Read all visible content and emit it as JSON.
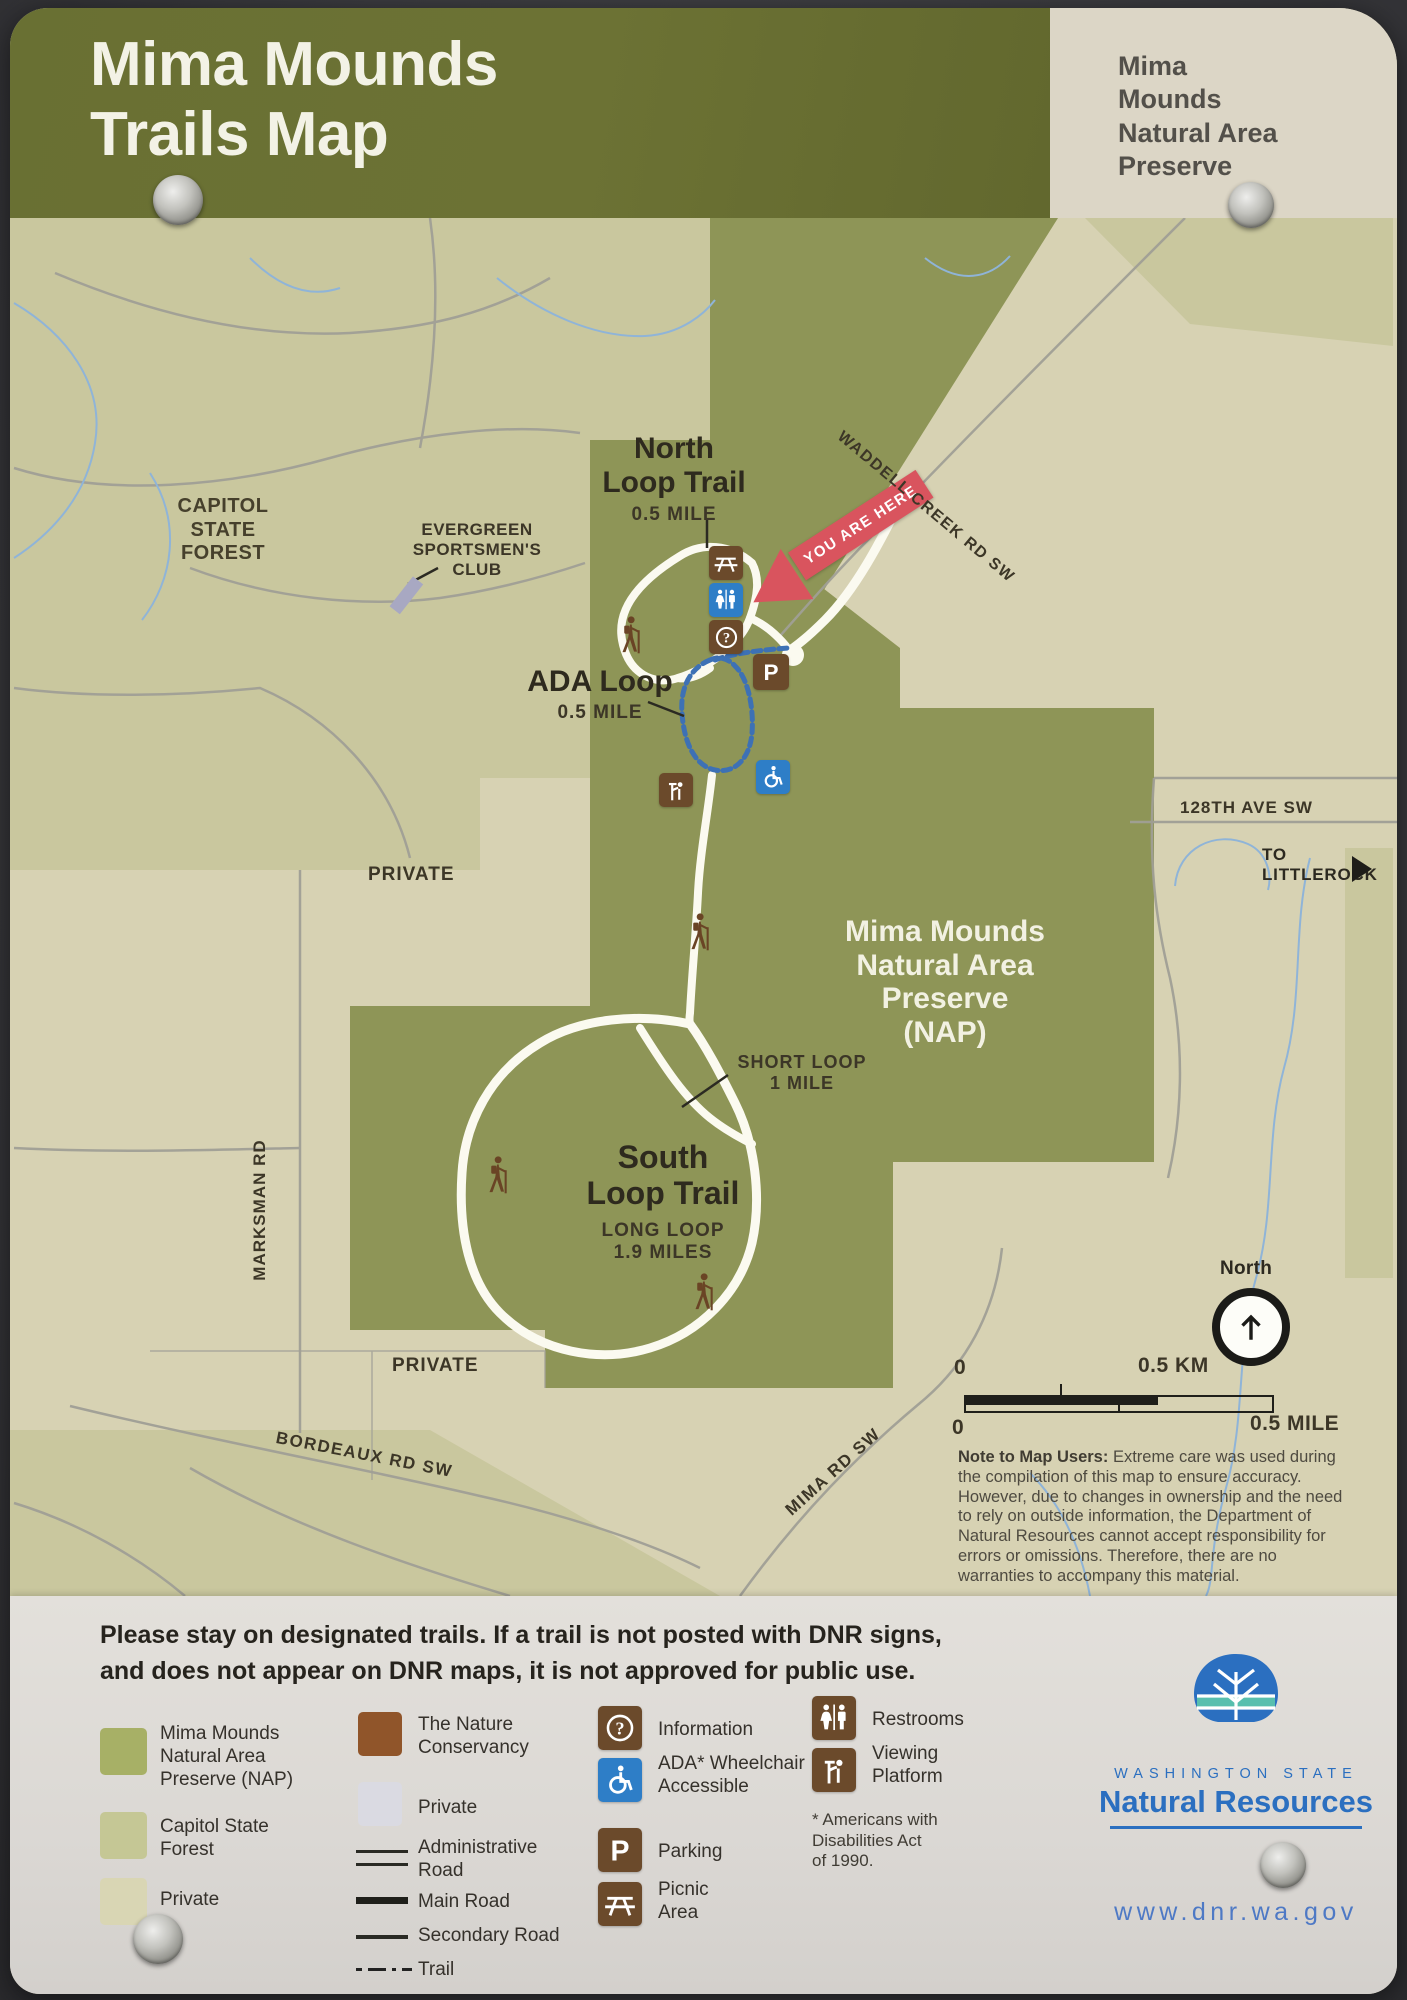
{
  "header": {
    "title": "Mima Mounds\nTrails Map",
    "corner_label": "Mima\nMounds\nNatural Area\nPreserve"
  },
  "map": {
    "labels": {
      "capitol_forest": "CAPITOL\nSTATE\nFOREST",
      "evergreen_club": "EVERGREEN\nSPORTSMEN'S\nCLUB",
      "north_loop_title": "North\nLoop Trail",
      "north_loop_distance": "0.5 MILE",
      "ada_loop_title": "ADA Loop",
      "ada_loop_distance": "0.5 MILE",
      "you_are_here": "YOU ARE HERE",
      "waddell_creek_rd": "WADDELL CREEK RD SW",
      "ave_128th": "128TH AVE SW",
      "to_littlerock": "TO LITTLEROCK",
      "private_upper": "PRIVATE",
      "private_lower": "PRIVATE",
      "nap_area": "Mima Mounds\nNatural Area\nPreserve\n(NAP)",
      "short_loop": "SHORT LOOP\n1 MILE",
      "south_loop_title": "South\nLoop Trail",
      "south_loop_sub": "LONG LOOP\n1.9 MILES",
      "marksman_rd": "MARKSMAN RD",
      "bordeaux_rd": "BORDEAUX RD SW",
      "mima_rd": "MIMA RD SW",
      "north_compass": "North"
    },
    "scale": {
      "zero_km": "0",
      "km": "0.5 KM",
      "zero_mile": "0",
      "mile": "0.5 MILE"
    },
    "note_title": "Note to Map Users:",
    "note_body": " Extreme care was used during the compilation of this map to ensure accuracy. However, due to changes in ownership and the need to rely on outside information, the Department of Natural Resources cannot accept responsibility for errors or omissions. Therefore, there are no warranties to accompany this material."
  },
  "legend": {
    "notice": "Please stay on designated trails. If a trail is not posted with DNR signs,\nand does not appear on DNR maps, it is not approved for public use.",
    "areas": {
      "nap": "Mima Mounds\nNatural Area\nPreserve (NAP)",
      "capitol": "Capitol State\nForest",
      "private": "Private"
    },
    "symbols": {
      "conservancy": "The Nature\nConservancy",
      "private": "Private",
      "admin_road": "Administrative\nRoad",
      "main_road": "Main Road",
      "secondary_road": "Secondary Road",
      "trail": "Trail"
    },
    "facilities": {
      "information": "Information",
      "ada_accessible": "ADA* Wheelchair\nAccessible",
      "parking": "Parking",
      "picnic": "Picnic\nArea",
      "restrooms": "Restrooms",
      "viewing": "Viewing\nPlatform",
      "ada_footnote": "* Americans with\nDisabilities Act\nof 1990."
    }
  },
  "footer": {
    "agency_state": "WASHINGTON STATE",
    "agency_name": "Natural Resources",
    "website": "www.dnr.wa.gov"
  },
  "colors": {
    "banner_olive": "#6a7034",
    "nap_green": "#8e9557",
    "forest_light": "#c9c79e",
    "private_cream": "#d7d2b3",
    "icon_brown": "#6b4a2b",
    "icon_blue": "#2e7ec7",
    "arrow_red": "#d9545e",
    "dnr_blue": "#2b6fc0"
  }
}
